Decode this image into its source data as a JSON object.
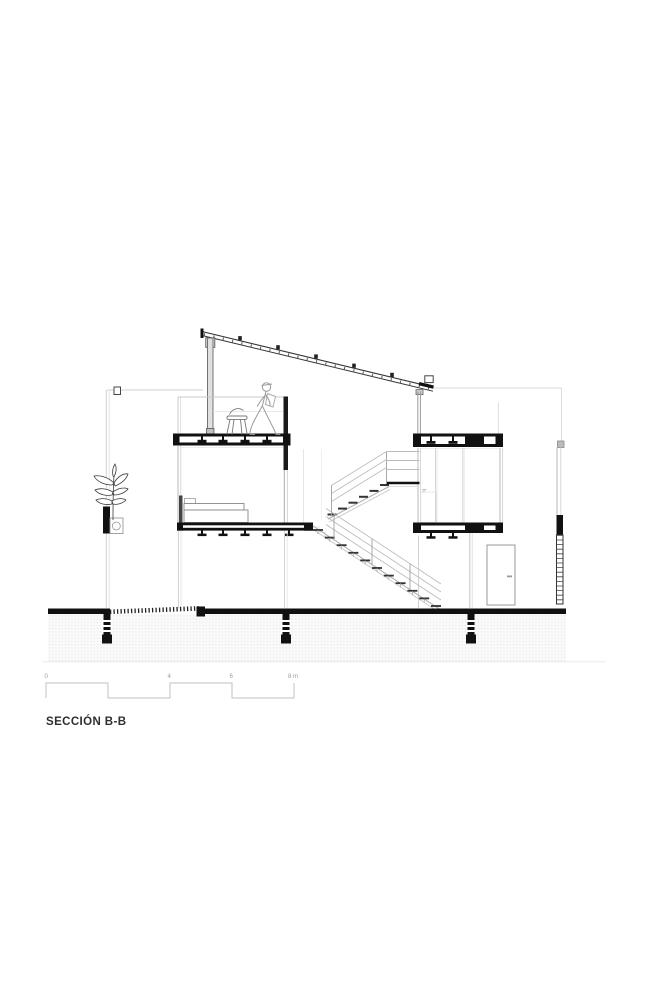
{
  "drawing": {
    "title": "SECCIÓN B-B",
    "scale_bar": {
      "labels": [
        "0",
        "4",
        "6",
        "8 m"
      ]
    },
    "colors": {
      "ink": "#1a1a1a",
      "line_medium": "#8a8a8a",
      "line_light": "#c0c0c0",
      "line_faint": "#e2e2e2",
      "paper": "#ffffff",
      "ground_hatch_dot": "#d8d8d8"
    }
  }
}
